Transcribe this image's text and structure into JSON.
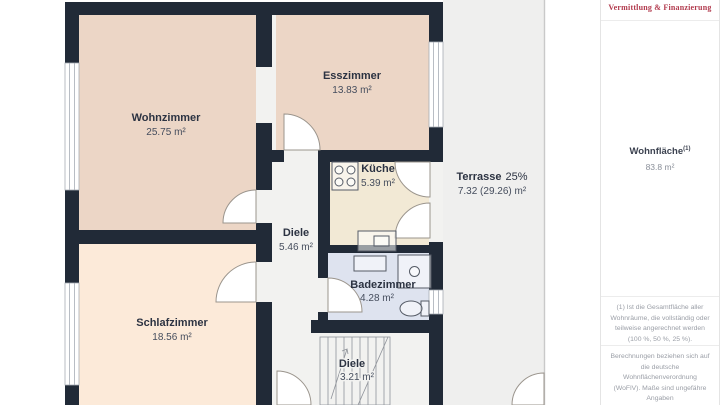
{
  "brand": {
    "tagline": "Vermittlung & Finanzierung",
    "accent_color": "#b23b4e"
  },
  "sidebar": {
    "wohnflaeche_label": "Wohnfläche",
    "wohnflaeche_sup": "(1)",
    "wohnflaeche_value": "83.8 m²",
    "footnote1": "(1) Ist die Gesamtfläche aller Wohnräume, die vollständig oder teilweise angerechnet werden (100 %, 50 %, 25 %).",
    "footnote2": "Berechnungen beziehen sich auf die deutsche Wohnflächenverordnung (WoFlV). Maße sind ungefähre Angaben"
  },
  "plan": {
    "rooms": {
      "wohnzimmer": {
        "name": "Wohnzimmer",
        "area": "25.75 m²"
      },
      "esszimmer": {
        "name": "Esszimmer",
        "area": "13.83 m²"
      },
      "kueche": {
        "name": "Küche",
        "area": "5.39 m²"
      },
      "diele_og": {
        "name": "Diele",
        "area": "5.46 m²"
      },
      "terrasse": {
        "name": "Terrasse",
        "pct": "25%",
        "area": "7.32 (29.26) m²"
      },
      "schlafzimmer": {
        "name": "Schlafzimmer",
        "area": "18.56 m²"
      },
      "badezimmer": {
        "name": "Badezimmer",
        "area": "4.28 m²"
      },
      "diele_unten": {
        "name": "Diele",
        "area": "3.21 m²"
      }
    },
    "colors": {
      "wall": "#212a37",
      "wohnzimmer": "#ecd6c6",
      "esszimmer": "#ecd6c6",
      "schlafzimmer": "#fcead9",
      "kueche": "#f2e9d5",
      "badezimmer": "#dee3ef",
      "flur": "#f2f2f0",
      "terrasse": "#efefee"
    }
  }
}
